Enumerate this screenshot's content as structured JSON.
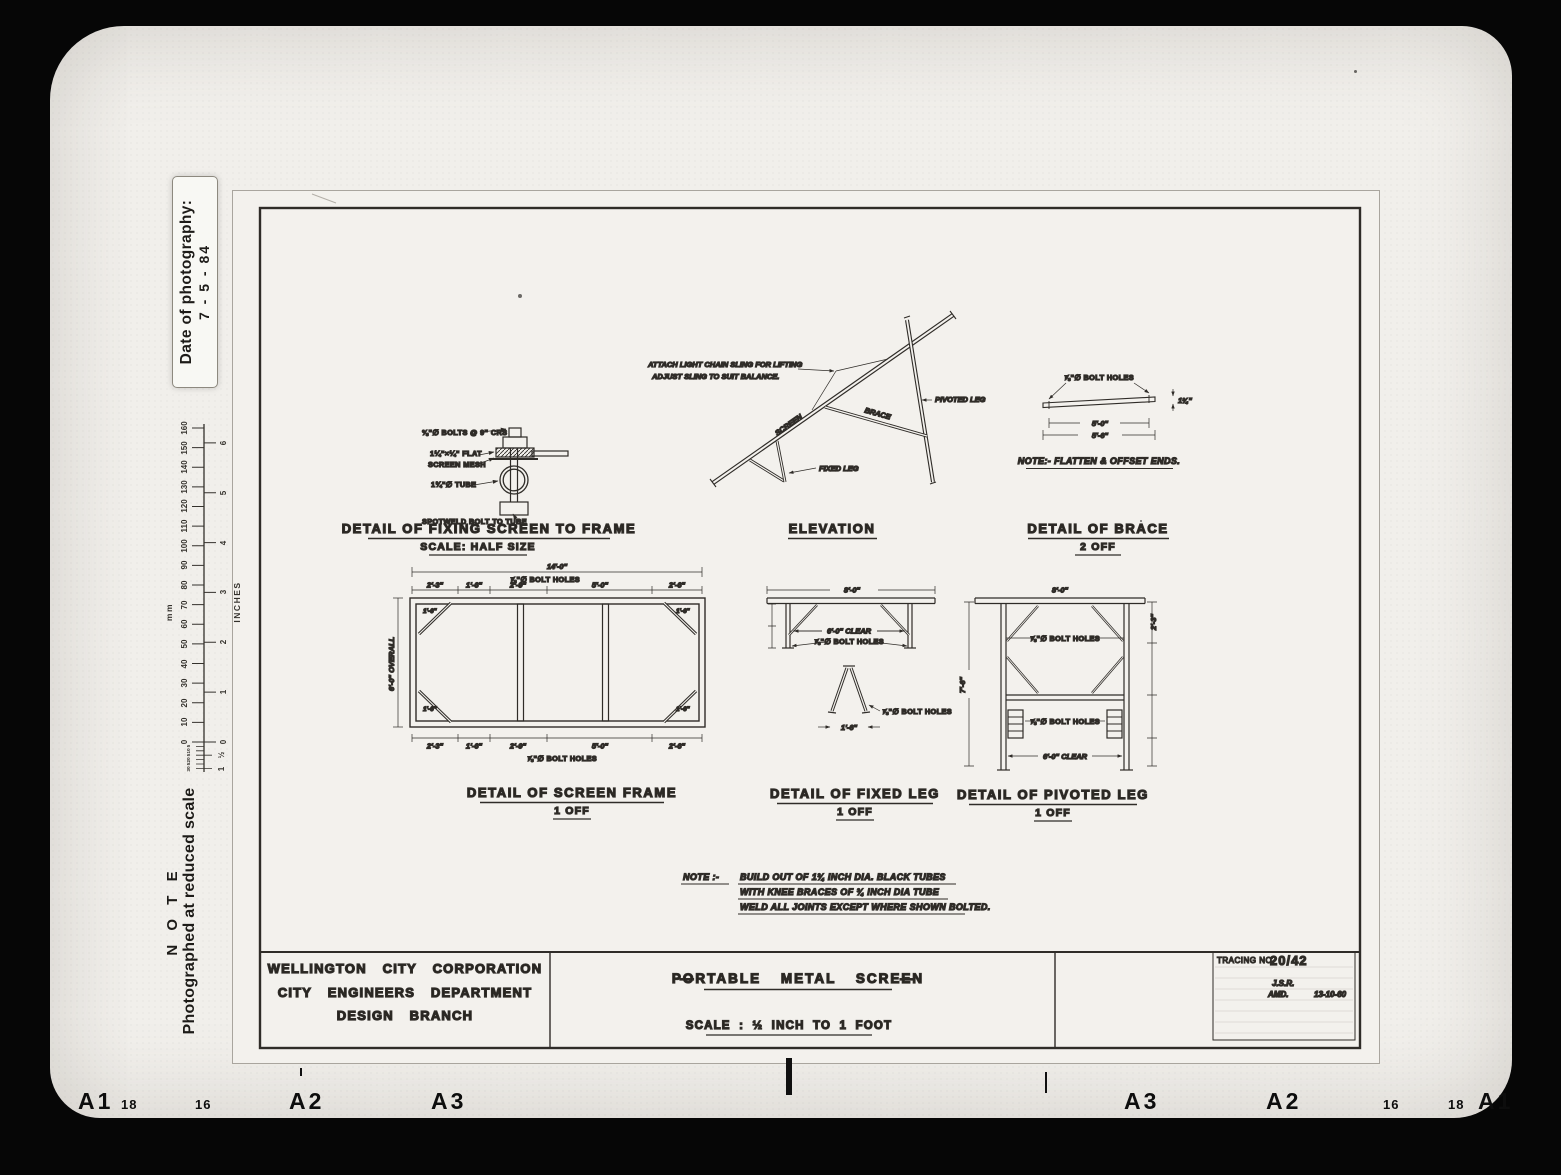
{
  "scan": {
    "date_label": "Date of photography:",
    "date_value": "7 - 5 - 84",
    "note_heading": "N O T E",
    "note_text": "Photographed at reduced scale",
    "ruler": {
      "mm_label": "mm",
      "inches_label": "INCHES",
      "mm_ticks": [
        "0",
        "10",
        "20",
        "30",
        "40",
        "50",
        "60",
        "70",
        "80",
        "90",
        "100",
        "110",
        "120",
        "130",
        "140",
        "150",
        "160"
      ],
      "mm_sub_ticks": [
        "5",
        "10",
        "5",
        "20",
        "5",
        "30"
      ],
      "inch_ticks": [
        "0",
        "1",
        "2",
        "3",
        "4",
        "5",
        "6"
      ],
      "inch_sub_ticks": [
        "½",
        "1"
      ]
    },
    "film_edge": {
      "left": [
        "A1",
        "18",
        "16",
        "A2",
        "A3"
      ],
      "right": [
        "A3",
        "A2",
        "16",
        "18",
        "A1"
      ]
    }
  },
  "drawings": {
    "fixing": {
      "title": "DETAIL OF FIXING SCREEN TO FRAME",
      "subtitle": "SCALE: HALF SIZE",
      "callout_bolts": "⅜\"∅ BOLTS @ 9\" CRS",
      "callout_flat": "1¼\"×¼\" FLAT",
      "callout_mesh": "SCREEN MESH",
      "callout_tube": "1¾\"∅ TUBE",
      "callout_spotweld": "SPOTWELD BOLT TO TUBE"
    },
    "elevation": {
      "title": "ELEVATION",
      "sling_note_line1": "ATTACH LIGHT CHAIN SLING FOR LIFTING",
      "sling_note_line2": "ADJUST SLING TO SUIT BALANCE.",
      "label_screen": "SCREEN",
      "label_brace": "BRACE",
      "label_fixed_leg": "FIXED LEG",
      "label_pivoted_leg": "PIVOTED LEG"
    },
    "brace": {
      "title": "DETAIL OF BRACE",
      "subtitle": "2 OFF",
      "bolt_holes": "⅞\"∅ BOLT HOLES",
      "dim_inner": "5'-0\"",
      "dim_outer": "5'-6\"",
      "dim_thickness": "1¾\"",
      "note": "NOTE:- FLATTEN & OFFSET ENDS."
    },
    "screen_frame": {
      "title": "DETAIL OF SCREEN FRAME",
      "subtitle": "1 OFF",
      "dim_overall_width": "14'-0\"",
      "dim_overall_height": "6'-0\" OVERALL",
      "segments": [
        "2'-3\"",
        "1'-6\"",
        "2'-9\"",
        "5'-0\"",
        "2'-6\""
      ],
      "bolt_holes_top": "⅞\"∅ BOLT HOLES",
      "bolt_holes_bottom": "⅞\"∅ BOLT HOLES",
      "corner_dim": "1'-6\""
    },
    "fixed_leg": {
      "title": "DETAIL OF FIXED LEG",
      "subtitle": "1 OFF",
      "dim_width": "8'-0\"",
      "dim_clear": "6'-0\" CLEAR",
      "bolt_holes": "⅞\"∅ BOLT HOLES",
      "aframe_bolt_holes": "⅞\"∅ BOLT HOLES",
      "aframe_base": "1'-6\""
    },
    "pivoted_leg": {
      "title": "DETAIL OF PIVOTED LEG",
      "subtitle": "1 OFF",
      "dim_width": "8'-0\"",
      "dim_height": "7'-6\"",
      "bolt_holes_mid": "⅞\"∅ BOLT HOLES",
      "bolt_holes_lower": "⅞\"∅ BOLT HOLES",
      "dim_clear": "6'-0\" CLEAR",
      "dim_right_top": "2'-3\""
    },
    "general_note": {
      "prefix": "NOTE :-",
      "line1": "BUILD OUT OF 1¾ INCH DIA. BLACK TUBES",
      "line2": "WITH KNEE BRACES OF ¾ INCH DIA TUBE",
      "line3": "WELD ALL JOINTS EXCEPT WHERE SHOWN BOLTED."
    }
  },
  "title_block": {
    "org_line1": "WELLINGTON CITY CORPORATION",
    "org_line2": "CITY ENGINEERS DEPARTMENT",
    "org_line3": "DESIGN BRANCH",
    "title_dash": "—",
    "drawing_title": "PORTABLE METAL SCREEN",
    "scale_note": "SCALE : ½ INCH TO 1 FOOT",
    "tracing_label": "TRACING NO.",
    "tracing_number": "20/42",
    "initials": "J.S.R.",
    "amendment": "AMD.",
    "amendment_date": "13-10-60"
  }
}
